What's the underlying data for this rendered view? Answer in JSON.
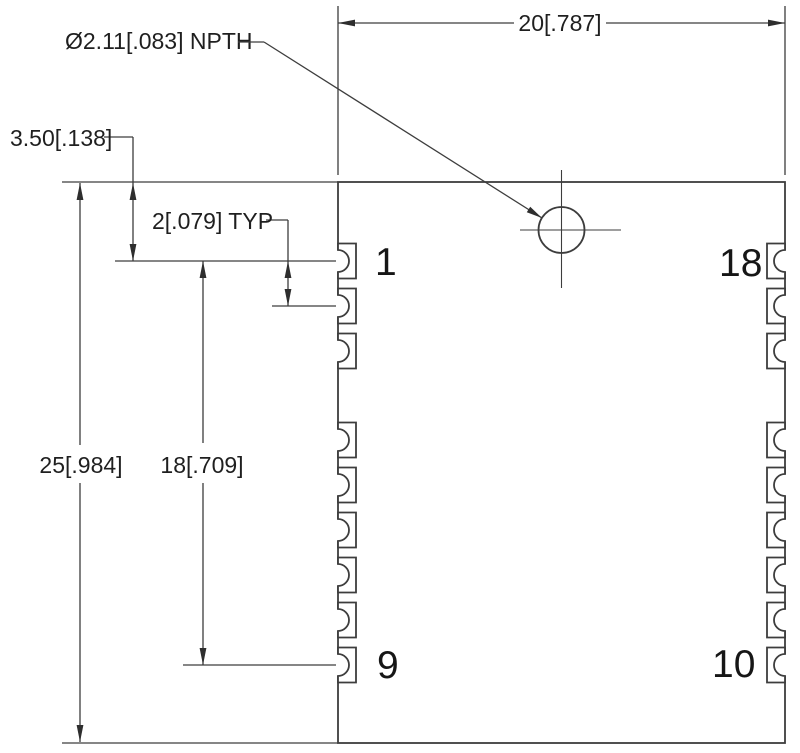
{
  "drawing": {
    "title": "PCB module package outline with castellated pins",
    "units": "millimeters [inches]",
    "colors": {
      "background": "#ffffff",
      "lines": "#3d3d3d",
      "dimension_text": "#1f1f1f",
      "pin_number_text": "#161616"
    },
    "dimensions": {
      "overall_width": "20[.787]",
      "overall_height": "25[.984]",
      "pin1_to_pin9_span": "18[.709]",
      "pin1_offset_from_top": "3.50[.138]",
      "pin_pitch": "2[.079] TYP",
      "hole_callout": "Ø2.11[.083] NPTH"
    },
    "pin_numbers": {
      "top_left": "1",
      "bottom_left": "9",
      "top_right": "18",
      "bottom_right": "10"
    }
  }
}
